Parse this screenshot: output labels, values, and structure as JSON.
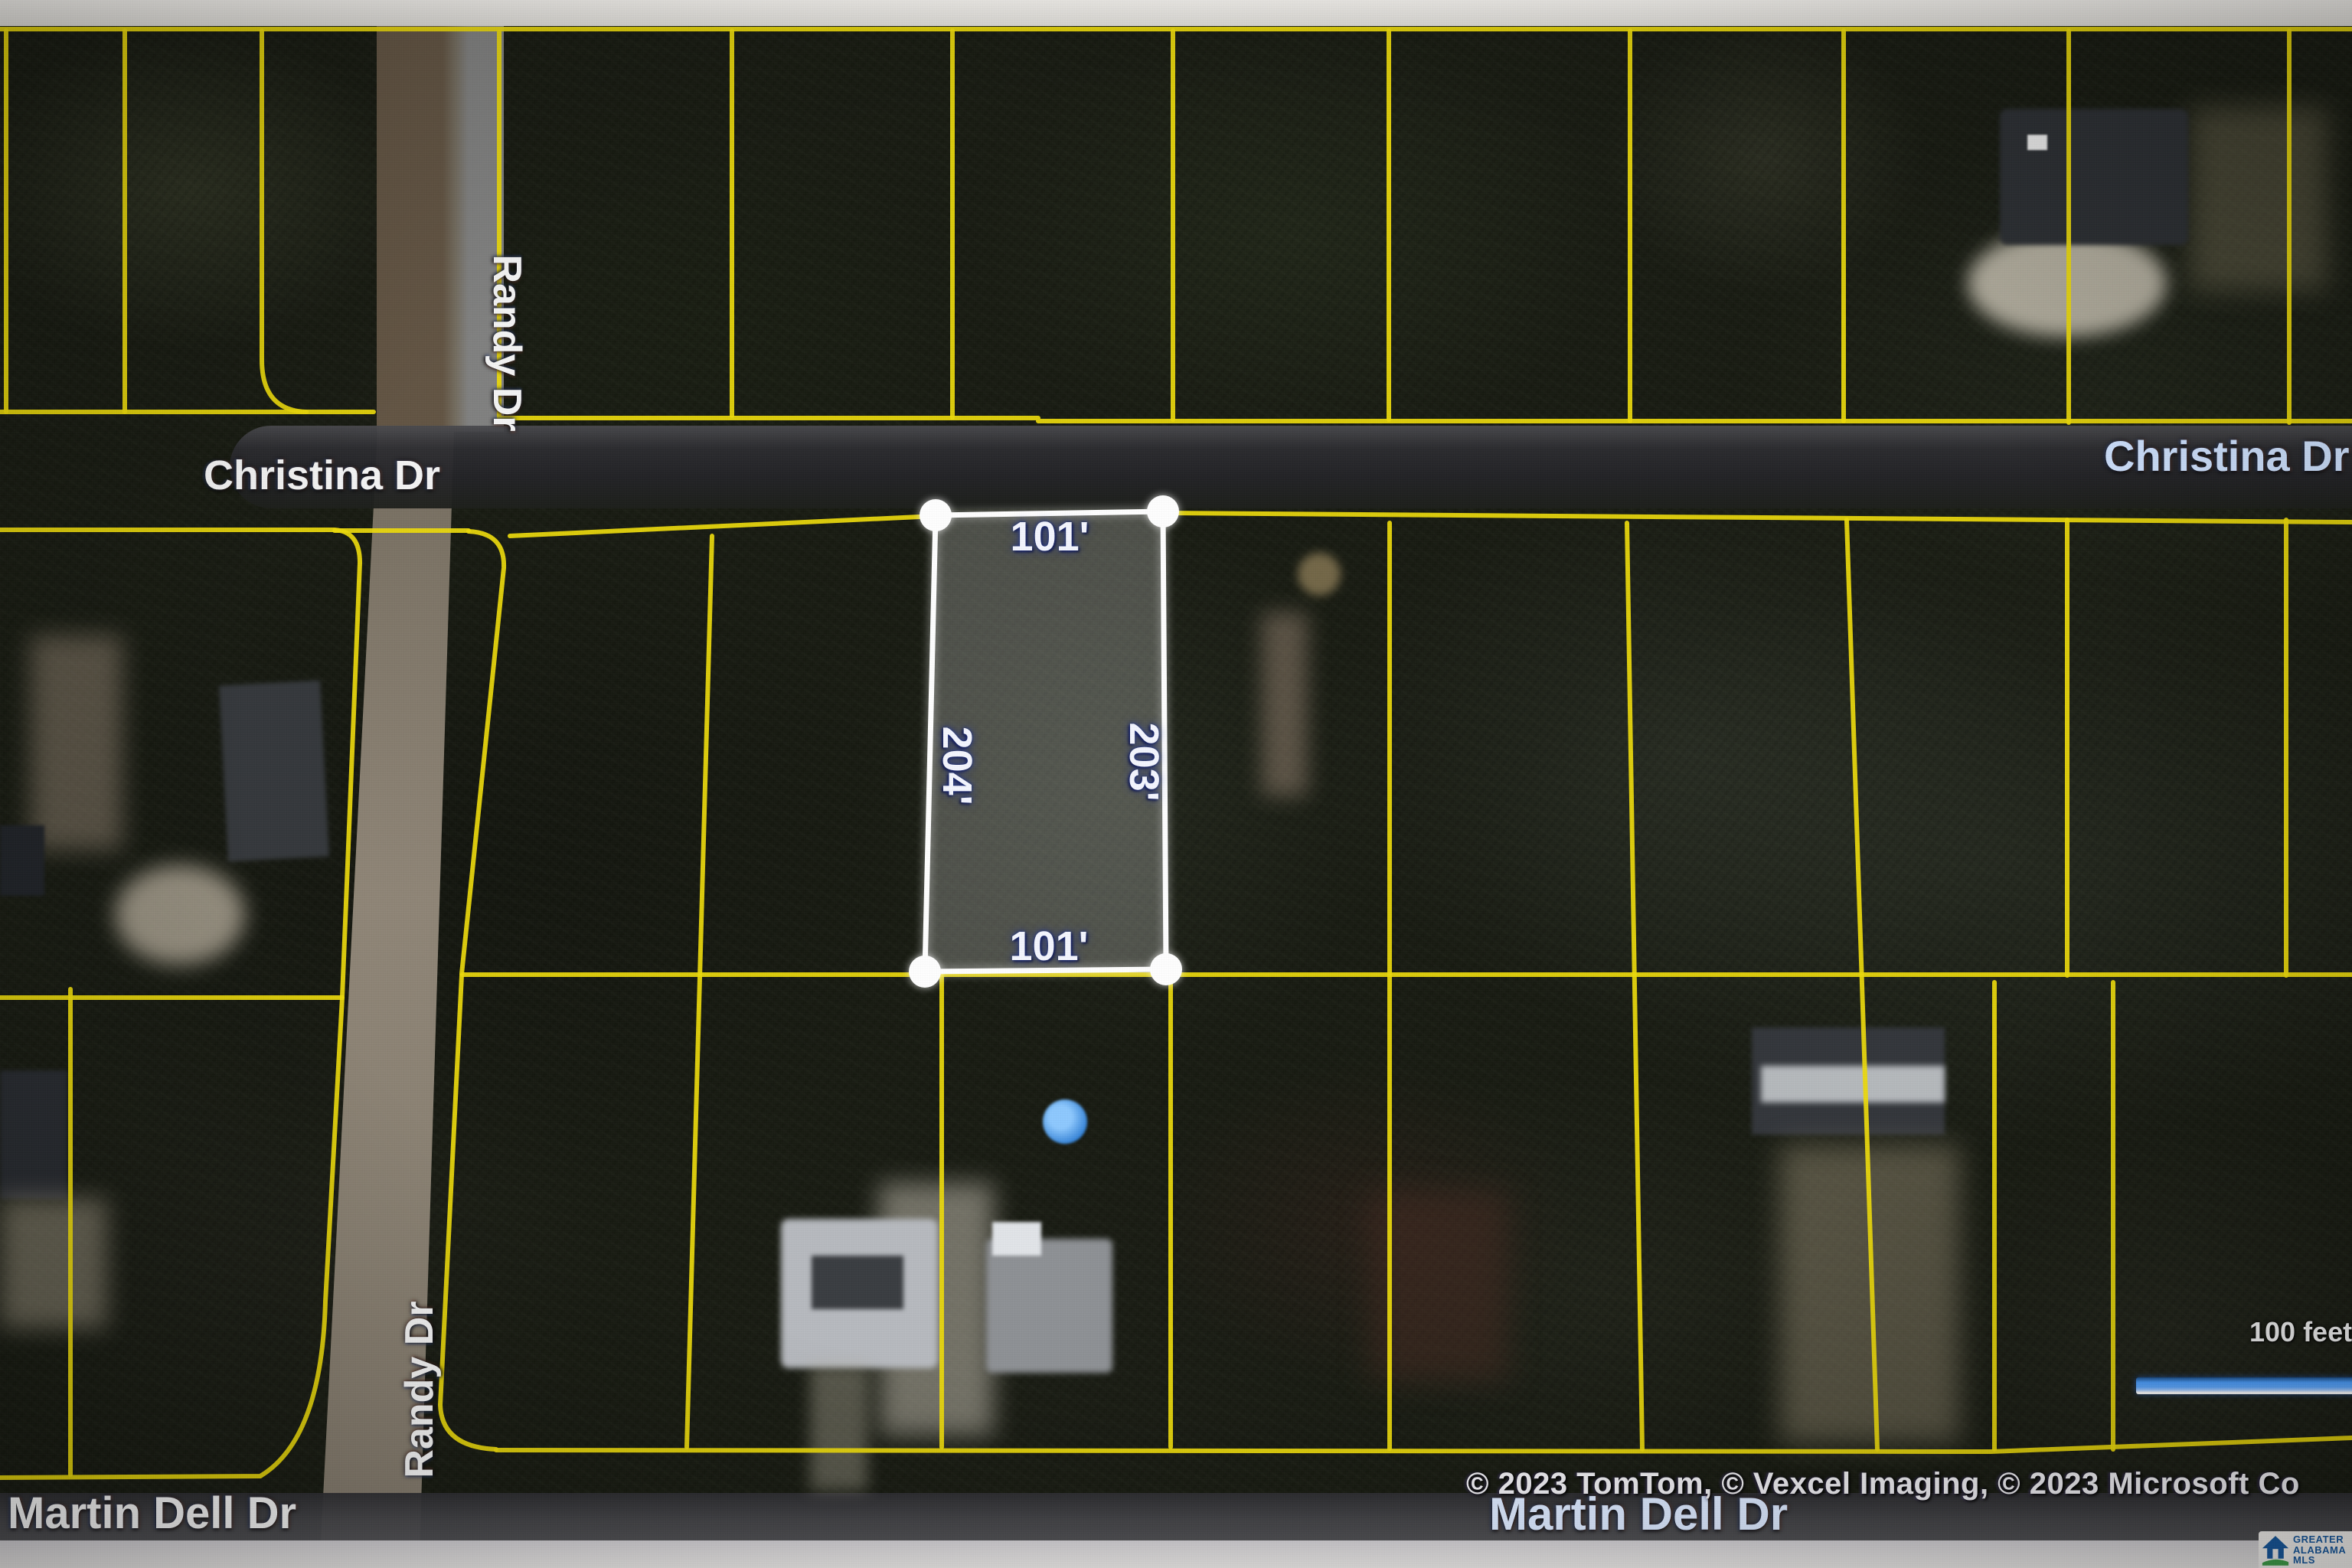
{
  "map": {
    "type": "aerial-parcel-map",
    "street_labels": {
      "randy_dr_top": "Randy Dr",
      "randy_dr_bottom": "Randy Dr",
      "christina_dr_left": "Christina Dr",
      "christina_dr_right": "Christina Dr",
      "martin_dell_dr_left": "Martin Dell Dr",
      "martin_dell_dr_center": "Martin Dell Dr"
    },
    "selected_parcel": {
      "top_dim": "101'",
      "left_dim": "204'",
      "right_dim": "203'",
      "bottom_dim": "101'"
    },
    "scale_bar": {
      "label": "100 feet"
    },
    "attribution": "© 2023 TomTom, © Vexcel Imaging, © 2023 Microsoft Co",
    "logo": {
      "line1": "GREATER",
      "line2": "ALABAMA",
      "line3": "MLS"
    },
    "colors": {
      "parcel_line_yellow": "#ecd90c",
      "selection_white": "#ffffff",
      "scale_bar_blue": "#4da0ff",
      "logo_blue": "#17599f",
      "logo_green": "#3fa14b"
    }
  }
}
